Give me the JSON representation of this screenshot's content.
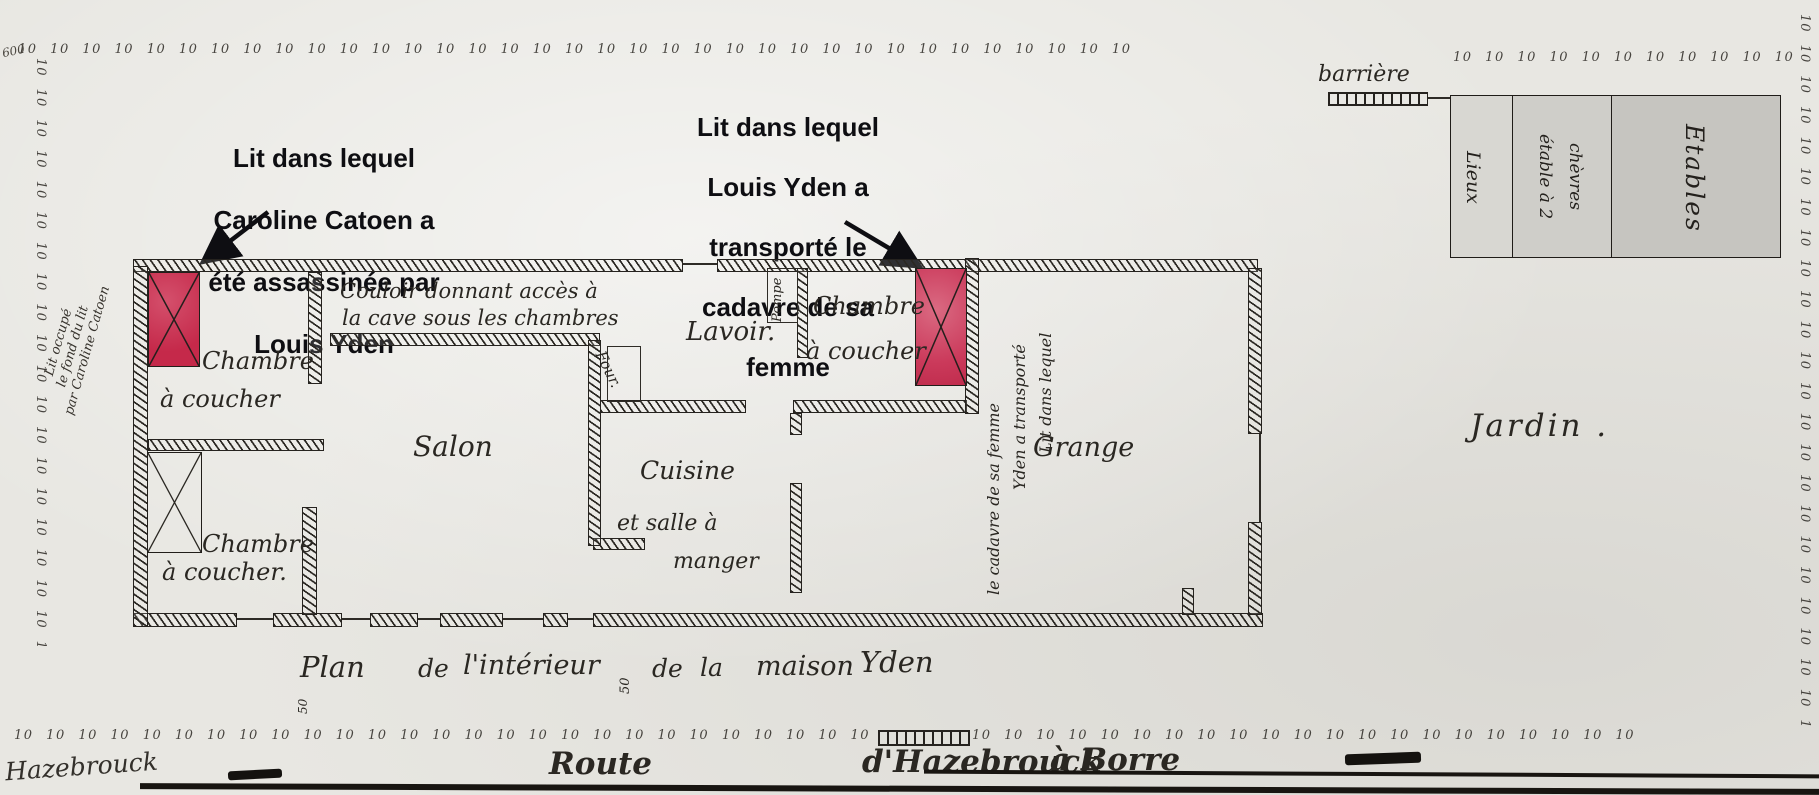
{
  "palette": {
    "paper": "#e8e7e2",
    "ink": "#2a2722",
    "bed_red_1": "#c5294a",
    "bed_red_2": "#cf4a67",
    "stable_gray_1": "#d8d7d2",
    "stable_gray_2": "#cfcec9",
    "stable_gray_3": "#c6c5c0",
    "annotation_ink": "#0e0e12"
  },
  "annotations": {
    "bed1_note": {
      "lines": [
        "Lit dans lequel",
        "Caroline Catoen a",
        "été assassinée par",
        "Louis Yden"
      ]
    },
    "bed2_note": {
      "lines": [
        "Lit dans lequel",
        "Louis Yden a",
        "transporté le",
        "cadavre de sa",
        "femme"
      ]
    }
  },
  "rooms": {
    "bedroom1": {
      "line1": "Chambre",
      "line2": "à coucher"
    },
    "bedroom2": {
      "line1": "Chambre",
      "line2": "à coucher."
    },
    "corridor": {
      "line1": "Couloir donnant accès à",
      "line2": "la cave sous les chambres"
    },
    "salon": "Salon",
    "four": "Four.",
    "cuisine": {
      "line1": "Cuisine",
      "line2": "et salle à",
      "line3": "manger"
    },
    "lavoir": "Lavoir.",
    "pompe": "Pompe",
    "mid_bedroom": {
      "line1": "Chambre",
      "line2": "à coucher"
    },
    "grange": "Grange",
    "jardin": "Jardin .",
    "stables": {
      "sec1": "Lieux",
      "sec2_line1": "étable à 2",
      "sec2_line2": "chèvres",
      "sec3": "Etables"
    },
    "barriere": "barrière"
  },
  "script_notes": {
    "bed2_vertical": {
      "line1": "Lit dans lequel",
      "line2": "Yden a transporté",
      "line3": "le cadavre de sa femme"
    },
    "left_margin": {
      "line1": "Lit occupé",
      "line2": "le fond du lit",
      "line3": "par Caroline Catoen"
    }
  },
  "caption": {
    "words": [
      "Plan",
      "de",
      "l'intérieur",
      "de",
      "la",
      "maison",
      "Yden"
    ],
    "measure": "50"
  },
  "road": {
    "town": "Hazebrouck",
    "words": [
      "Route",
      "d'Hazebrouck",
      "à Borre"
    ]
  },
  "measures": {
    "frontage": "50"
  },
  "decor": {
    "marks": "10 10 10 10 10 10 10 10 10 10 10 10 10 10 10 10 10 10 10 10 10 10 10 10 10 10 10 10 10 10 10 10 10 10 10 10 10 10 10 10 10 10 10 10 10 10 10 10 10 10 10 10 10 10 10 10 10 10 10 10 10 10 10 10 10 10 10 10 10 10",
    "corner_mark": "600"
  }
}
